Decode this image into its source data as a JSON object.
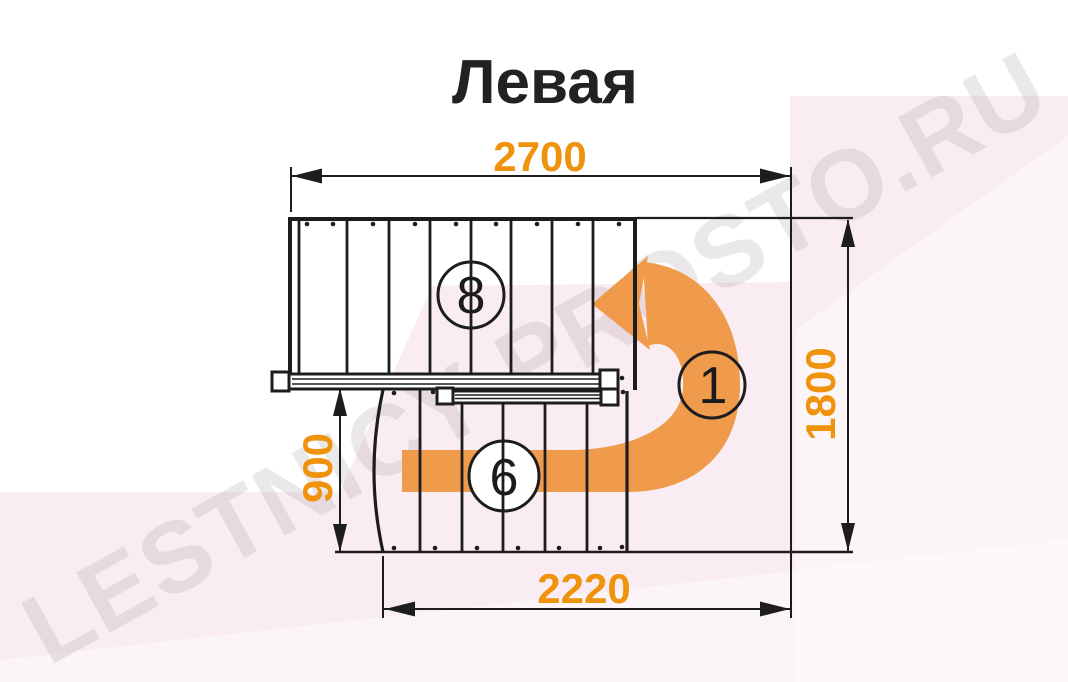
{
  "title": "Левая",
  "watermark": "LESTNICY-PROSTO.RU",
  "dimensions": {
    "top_width_mm": "2700",
    "right_height_mm": "1800",
    "left_flight_width_mm": "900",
    "bottom_width_mm": "2220"
  },
  "step_labels": {
    "upper_flight": "8",
    "lower_flight": "6",
    "first_step": "1"
  },
  "colors": {
    "dimension_orange": "#EF930D",
    "arrow_orange": "#F09B4B",
    "line_black": "#1D1D1F",
    "background_pink": "#F9EDF3"
  }
}
